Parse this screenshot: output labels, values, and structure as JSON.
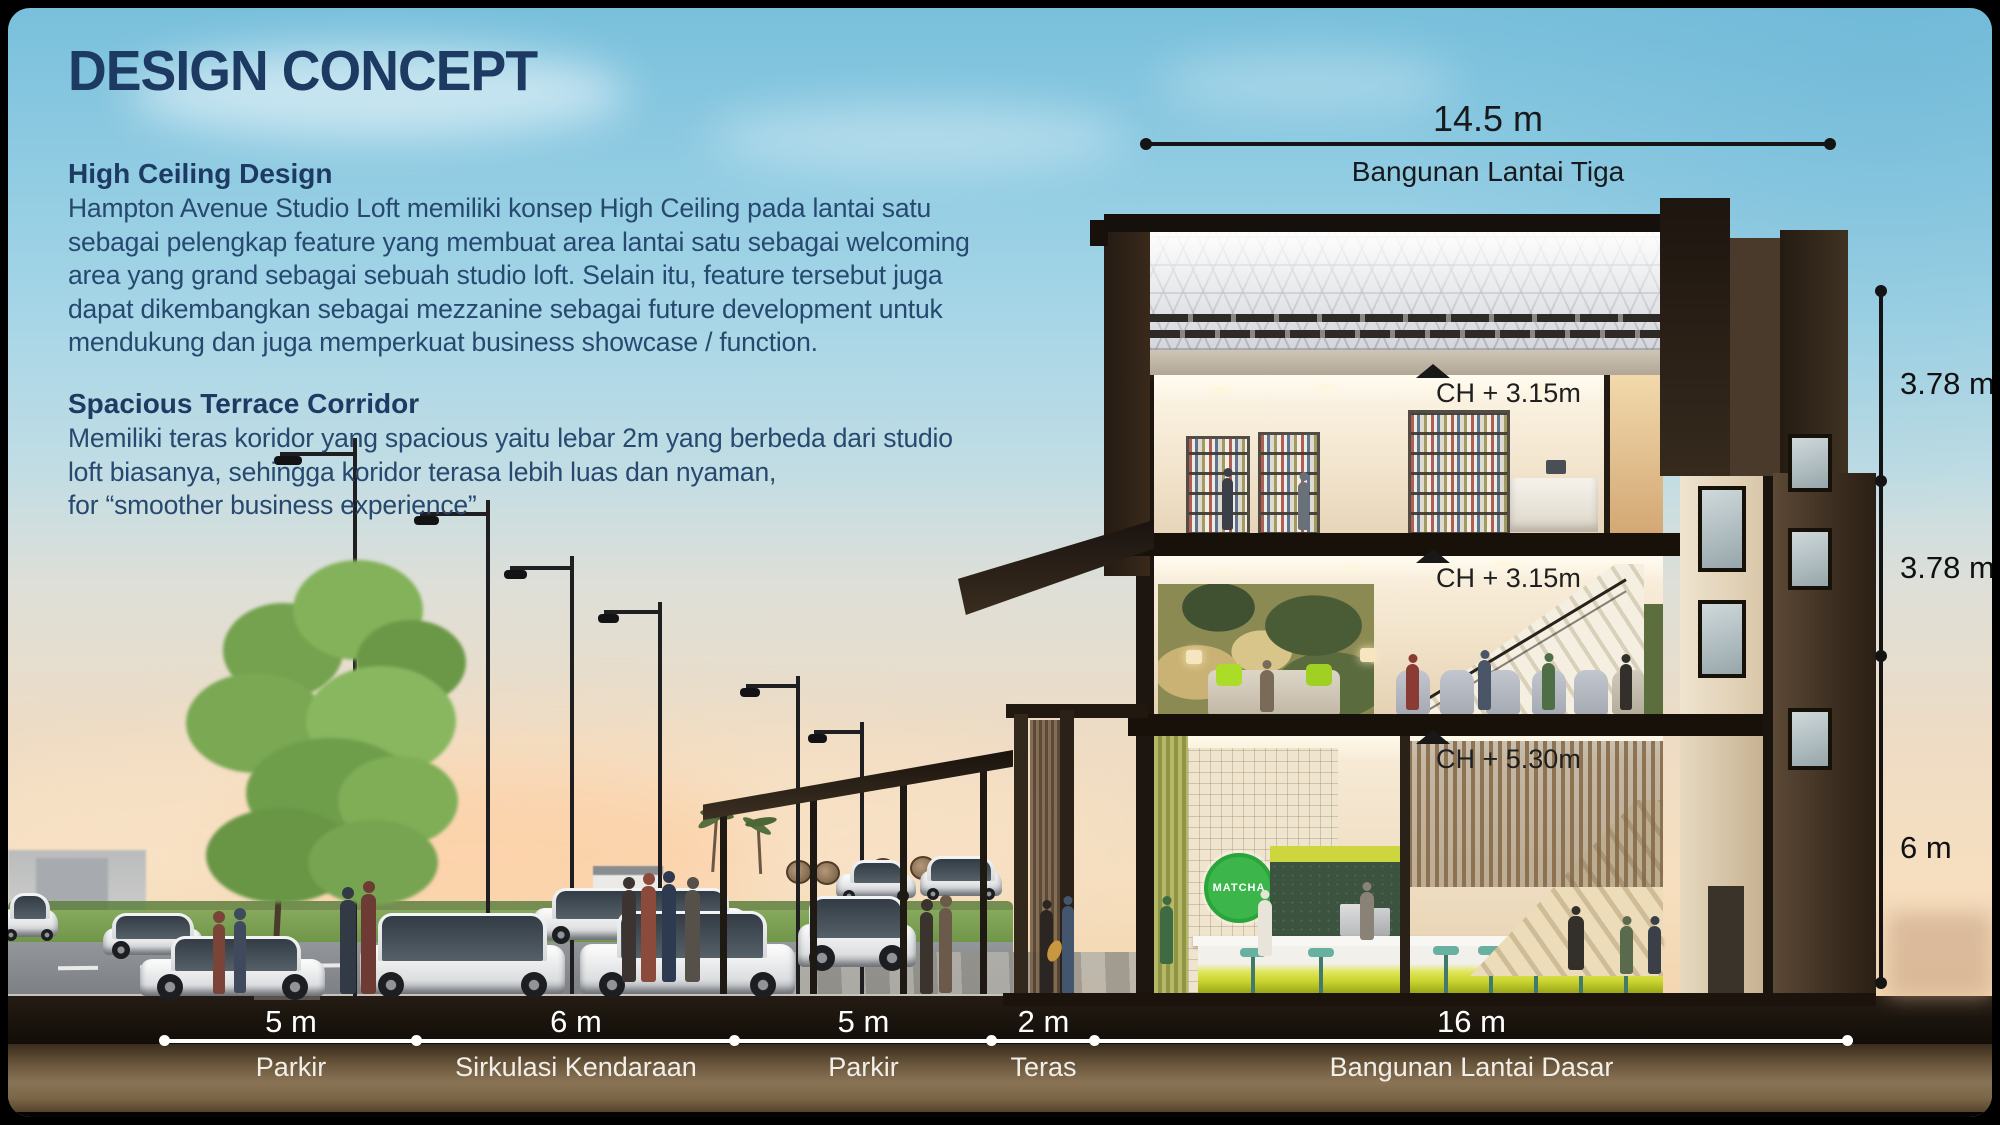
{
  "slide": {
    "title": "DESIGN CONCEPT",
    "sections": [
      {
        "heading": "High Ceiling Design",
        "body": "Hampton Avenue Studio Loft memiliki konsep High Ceiling pada lantai satu\nsebagai pelengkap feature yang membuat area lantai satu sebagai welcoming\narea yang grand sebagai sebuah studio loft. Selain itu, feature tersebut juga\ndapat dikembangkan sebagai mezzanine sebagai future development untuk\nmendukung dan juga memperkuat business showcase / function."
      },
      {
        "heading": "Spacious Terrace Corridor",
        "body": "Memiliki teras koridor yang spacious yaitu lebar 2m yang berbeda dari studio\nloft biasanya, sehingga koridor terasa lebih luas dan nyaman,\nfor “smoother business experience”"
      }
    ]
  },
  "dimensions": {
    "top": {
      "value": "14.5 m",
      "label": "Bangunan Lantai Tiga"
    },
    "right": [
      {
        "value": "3.78 m"
      },
      {
        "value": "3.78 m"
      },
      {
        "value": "6 m"
      }
    ],
    "bottom": [
      {
        "value": "5 m",
        "label": "Parkir"
      },
      {
        "value": "6 m",
        "label": "Sirkulasi Kendaraan"
      },
      {
        "value": "5 m",
        "label": "Parkir"
      },
      {
        "value": "2 m",
        "label": "Teras"
      },
      {
        "value": "16 m",
        "label": "Bangunan Lantai Dasar"
      }
    ]
  },
  "ceiling_heights": [
    {
      "value": "CH + 3.15m"
    },
    {
      "value": "CH + 3.15m"
    },
    {
      "value": "CH + 5.30m"
    }
  ],
  "illustration": {
    "cafe_logo": "MATCHA"
  },
  "colors": {
    "heading_text": "#1d3a63",
    "body_text": "#27496f",
    "dimension_text_dark": "#141414",
    "dimension_text_light": "#ffffff",
    "cafe_logo_green": "#3cb54a",
    "counter_glow": "#c9d42e",
    "sky_top": "#79c0dc",
    "sunset": "#f6dfc0",
    "ground_brown": "#8a7456"
  }
}
